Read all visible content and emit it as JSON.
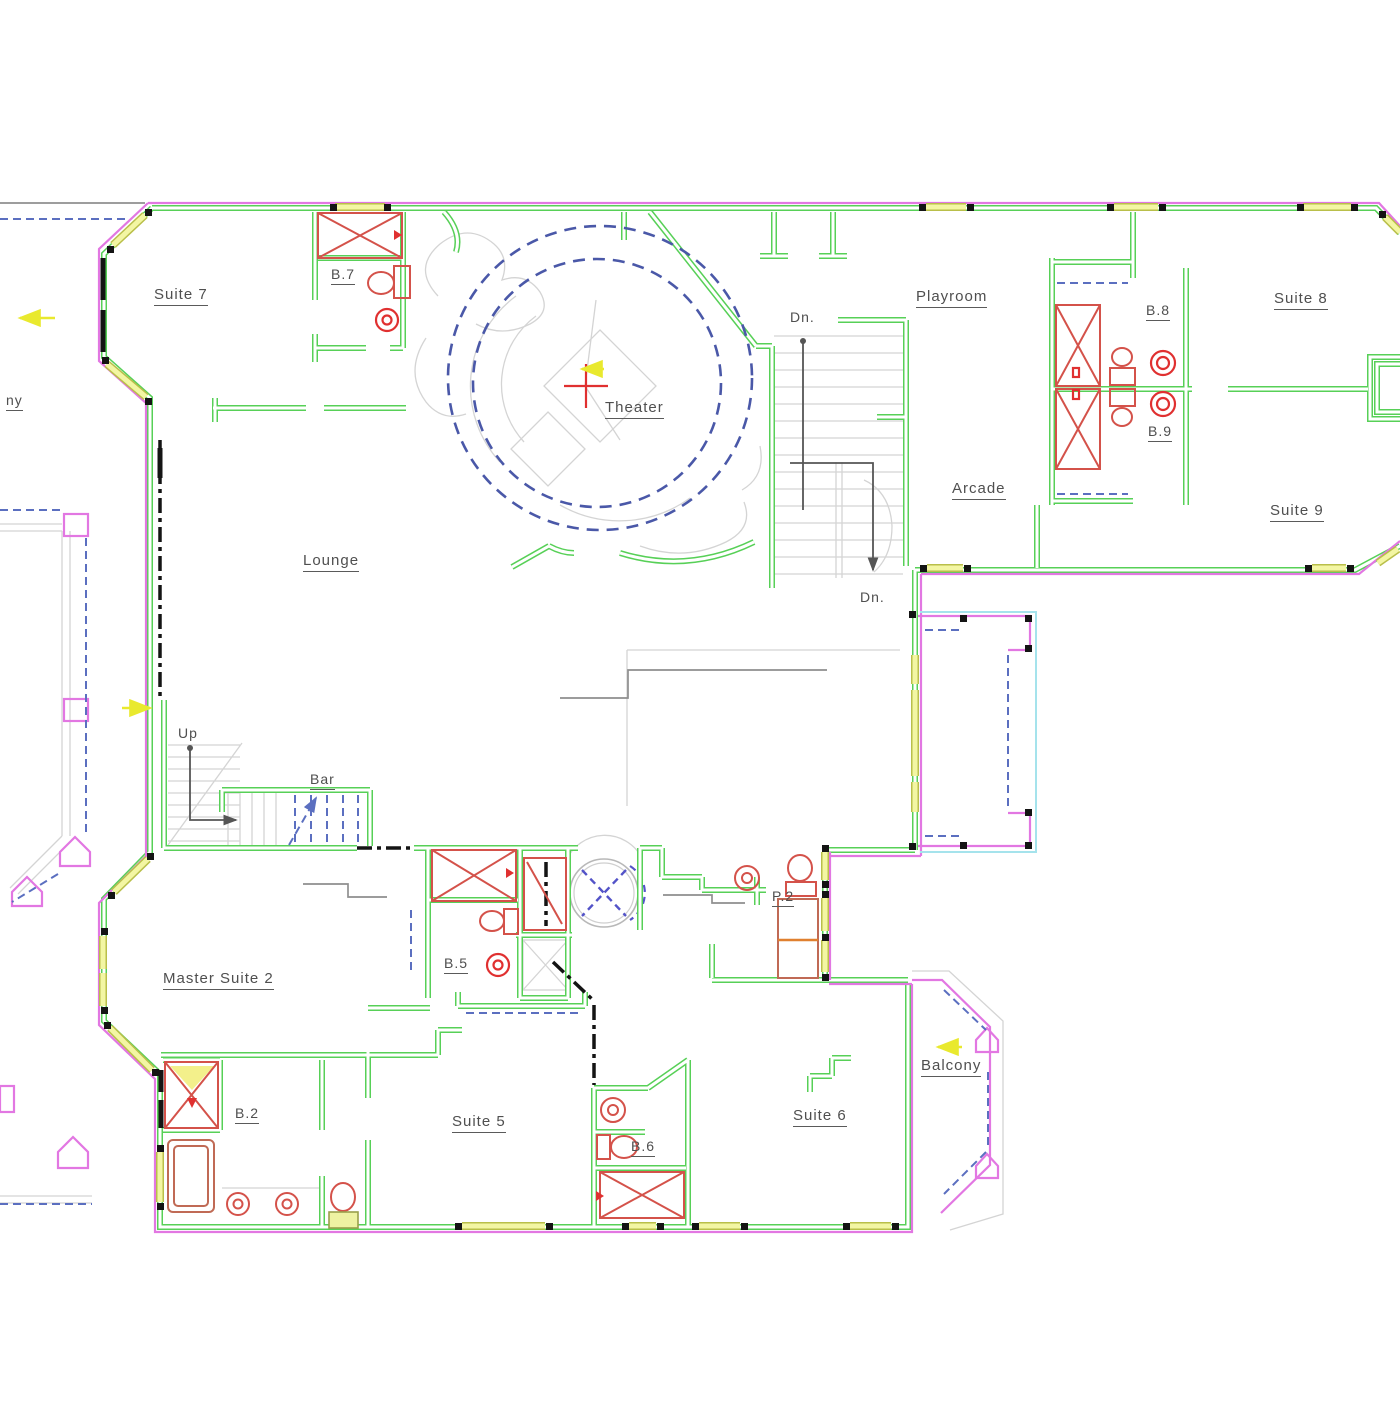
{
  "labels": {
    "suite7": "Suite 7",
    "b7": "B.7",
    "theater": "Theater",
    "dn_top": "Dn.",
    "playroom": "Playroom",
    "b8": "B.8",
    "suite8": "Suite 8",
    "arcade": "Arcade",
    "b9": "B.9",
    "suite9": "Suite 9",
    "lounge": "Lounge",
    "dn_bottom": "Dn.",
    "balcony_left_partial": "ny",
    "up": "Up",
    "bar": "Bar",
    "master_suite2": "Master Suite 2",
    "b5": "B.5",
    "p2": "P.2",
    "b2": "B.2",
    "suite5": "Suite 5",
    "b6": "B.6",
    "suite6": "Suite 6",
    "balcony_right": "Balcony"
  },
  "palette": {
    "wall_green": "#57d057",
    "exterior_magenta": "#e277e2",
    "window_yellow": "#f3f6a3",
    "fixture_red": "#d4524a",
    "annotation_blue": "#5b6fc0",
    "balcony_cyan": "#a5e3ec",
    "stair_gray": "#d4d4d4",
    "text_gray": "#4f4f4f",
    "marker_yellow": "#e9e92e"
  }
}
